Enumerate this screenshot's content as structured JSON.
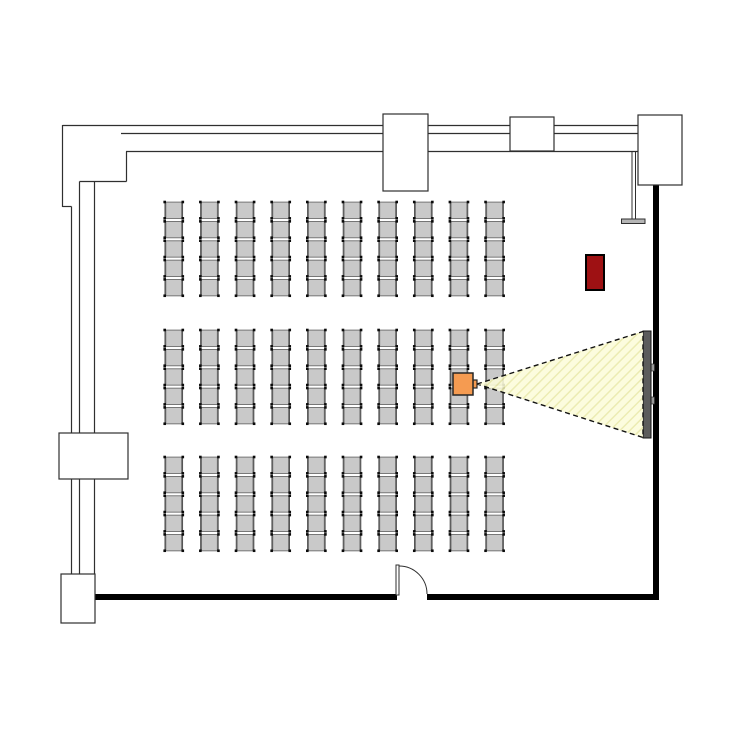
{
  "app": {
    "title": "Seminar room floor plan",
    "description": "Plan view of a lecture room with theatre seating, a projector with projection beam onto a wall screen, a door and a red cabinet"
  },
  "canvas": {
    "width": 750,
    "height": 750,
    "background": "#ffffff",
    "line_color": "#2f2f2f",
    "wall_solid_color": "#000000"
  },
  "walls": {
    "thin_lines": [
      [
        62.5,
        125.5,
        638,
        125.5
      ],
      [
        121,
        133.5,
        638,
        133.5
      ],
      [
        126,
        151.5,
        638,
        151.5
      ],
      [
        62.5,
        125,
        62.5,
        207
      ],
      [
        62.5,
        206.5,
        71.5,
        206.5
      ],
      [
        71.5,
        206.5,
        71.5,
        433
      ],
      [
        79.5,
        181.5,
        79.5,
        433
      ],
      [
        94.5,
        181.5,
        94.5,
        433
      ],
      [
        79.5,
        181.5,
        126.5,
        181.5
      ],
      [
        126.5,
        151.5,
        126.5,
        181.5
      ],
      [
        71.5,
        479,
        71.5,
        574
      ],
      [
        79.5,
        479,
        79.5,
        574
      ],
      [
        94.5,
        479,
        94.5,
        574
      ]
    ],
    "thick_rects": [
      [
        95,
        594,
        302,
        6
      ],
      [
        427,
        594,
        232,
        6
      ],
      [
        653,
        184,
        6,
        416
      ]
    ],
    "pillars": [
      [
        383,
        114,
        45,
        77
      ],
      [
        510,
        117,
        44,
        34
      ],
      [
        638,
        115,
        44,
        70
      ],
      [
        59,
        433,
        69,
        46
      ],
      [
        61,
        574,
        34,
        49
      ]
    ]
  },
  "door": {
    "leaf": [
      396,
      565,
      3,
      30
    ],
    "arc_path": "M 399 566 A 28 28 0 0 1 427 594"
  },
  "seating": {
    "total_chairs": 150,
    "blocks": 3,
    "rows_per_block": 5,
    "columns": 10,
    "blocks_y": [
      200.5,
      328.5,
      455.5
    ],
    "origin_x": 163,
    "col_pitch": 35.65,
    "row_pitch": 19.35,
    "chair_w": 21.5,
    "chair_h": 19.35,
    "seat_fill": "#c9c9c9",
    "seat_stroke": "#6b6b6b",
    "rail_color": "#555555",
    "foot_color": "#0a0a0a"
  },
  "projector": {
    "body": [
      453,
      373,
      20,
      22
    ],
    "lens": [
      472.5,
      380,
      4.5,
      8
    ],
    "fill": "#f59b51",
    "stroke": "#262626"
  },
  "beam": {
    "apex": [
      477,
      384
    ],
    "screen_top": [
      643,
      331.5
    ],
    "screen_bottom": [
      643,
      437.5
    ],
    "fill": "#fcfcda",
    "hatch_color": "#e9e9a8",
    "outline_color": "#111111",
    "outline_dash": "5 3.5"
  },
  "screen": {
    "bar": [
      643,
      331,
      8,
      107
    ],
    "fill": "#5c5c5c",
    "stroke": "#161616",
    "brackets": [
      [
        650.5,
        364,
        4,
        7
      ],
      [
        650.5,
        397,
        4,
        7
      ]
    ],
    "bracket_fill": "#9a9a9a"
  },
  "wall_fixture": {
    "pole_x1": 632,
    "pole_x2": 635.5,
    "pole_top": 152,
    "pole_bottom": 219,
    "bar": [
      621.5,
      219,
      23.5,
      4.5
    ],
    "bar_fill": "#b5b5b5"
  },
  "cabinet": {
    "rect": [
      586,
      255,
      18,
      35
    ],
    "fill": "#9e1113",
    "stroke": "#000000"
  },
  "stamp": {
    "box": [
      620,
      562,
      29,
      31
    ],
    "checker_color": "#8e8e8e",
    "inner_fill": "#ffffff",
    "text": "PA",
    "text_color": "#3d3d3d",
    "rotated_deg": 180
  }
}
